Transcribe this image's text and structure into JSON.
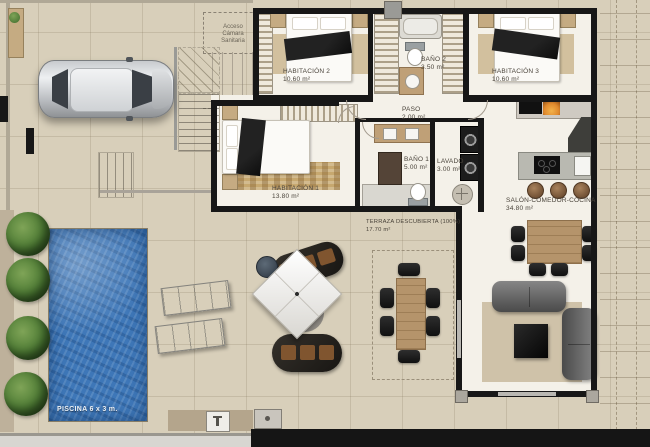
{
  "plan_title": "Floor plan",
  "rooms": {
    "habitacion2": {
      "name": "HABITACIÓN 2",
      "area": "10.60 m²"
    },
    "bano2": {
      "name": "BAÑO 2",
      "area": "3.50 m²"
    },
    "habitacion3": {
      "name": "HABITACIÓN 3",
      "area": "10.60 m²"
    },
    "paso": {
      "name": "PASO",
      "area": "2.00 m²"
    },
    "habitacion1": {
      "name": "HABITACIÓN 1",
      "area": "13.80 m²"
    },
    "bano1": {
      "name": "BAÑO 1",
      "area": "5.00 m²"
    },
    "lavado": {
      "name": "LAVADO",
      "area": "3.00 m²"
    },
    "salon": {
      "name": "SALÓN-COMEDOR-COCINA",
      "area": "34.80 m²"
    },
    "terraza": {
      "name": "TERRAZA DESCUBIERTA (100%)",
      "area": "17.70 m²"
    }
  },
  "pool": {
    "label": "PISCINA 6 x 3 m."
  },
  "annotations": {
    "acceso": "Acceso\nCámara\nSanitaria"
  },
  "colors": {
    "wall": "#171717",
    "interior_floor": "#f4f1e9",
    "exterior_paving": "#d8cfba",
    "pool_water": "#3e77b8",
    "wood": "#b5946b",
    "plant": "#4c7a33",
    "fireplace": "#e08a2e"
  }
}
